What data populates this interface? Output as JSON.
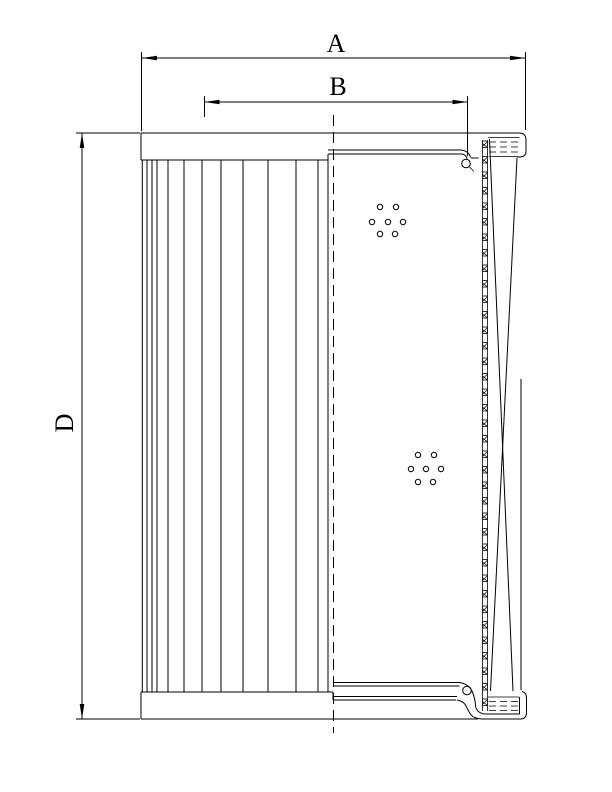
{
  "drawing": {
    "kind": "filter-element-cross-section",
    "labels": {
      "width": "A",
      "inner_width": "B",
      "height": "D"
    },
    "colors": {
      "line": "#000000",
      "background": "#ffffff"
    }
  }
}
